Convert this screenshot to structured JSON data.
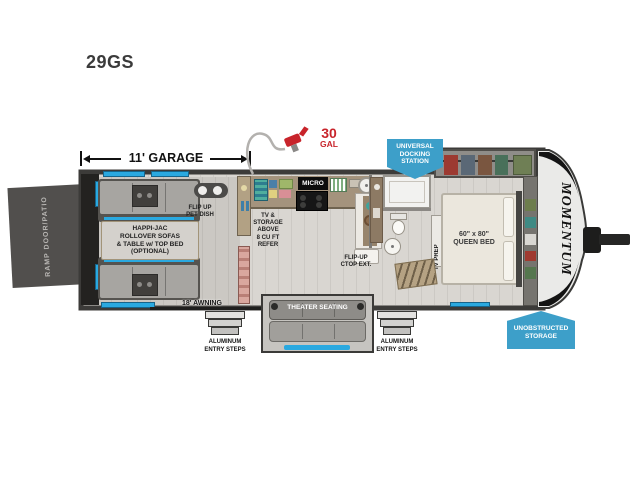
{
  "title": "29GS",
  "garage_dim": "11' GARAGE",
  "fuel": {
    "amount": "30",
    "unit": "GAL"
  },
  "badges": {
    "docking": [
      "UNIVERSAL",
      "DOCKING",
      "STATION"
    ],
    "storage": [
      "UNOBSTRUCTED",
      "STORAGE"
    ]
  },
  "garage": {
    "ramp": "RAMP DOOR/PATIO",
    "sofas": [
      "HAPPI-JAC",
      "ROLLOVER SOFAS",
      "& TABLE w/ TOP BED",
      "(OPTIONAL)"
    ],
    "pet_dish": [
      "FLIP UP",
      "PET DISH"
    ]
  },
  "kitchen": {
    "micro": "MICRO",
    "refer": [
      "TV &",
      "STORAGE",
      "ABOVE",
      "8 CU FT",
      "REFER"
    ],
    "ctop": [
      "FLIP-UP",
      "CTOP EXT."
    ]
  },
  "bedroom": {
    "tv_prep": "TV PREP",
    "bed": [
      "60\" x 80\"",
      "QUEEN BED"
    ]
  },
  "exterior": {
    "awning": "18' AWNING",
    "theater": "THEATER SEATING",
    "steps_left": [
      "ALUMINUM",
      "ENTRY STEPS"
    ],
    "steps_right": [
      "ALUMINUM",
      "ENTRY STEPS"
    ],
    "brand": "MOMENTUM"
  },
  "colors": {
    "accent_blue": "#2aa9e0",
    "badge_blue": "#3d9fc9",
    "fuel_red": "#c8242b",
    "wall_dark": "#3c3b39",
    "floor_gray": "#d8d5d0",
    "counter_tan": "#a4937d"
  }
}
